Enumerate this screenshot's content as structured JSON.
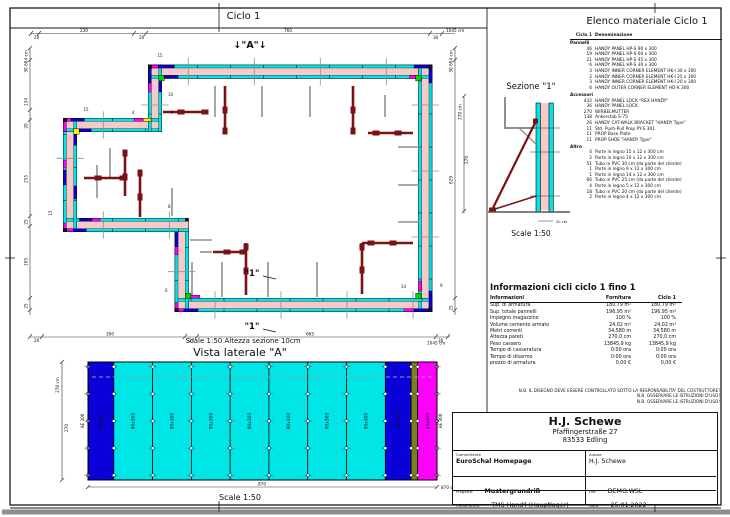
{
  "colors": {
    "panel_cyan": "#00e6e6",
    "concrete_pink": "#f7c9c9",
    "panel_blue": "#0a00d8",
    "panel_magenta": "#ff00ff",
    "panel_green": "#00d400",
    "panel_yellow": "#ffee00",
    "prop_maroon": "#7c1114",
    "wood_olive": "#7e7d1d",
    "gray_line": "#8f8f8f",
    "frame": "#1a1a1a"
  },
  "plan": {
    "title": "Ciclo 1",
    "scale_note": "Scale 1:50   Altezza sezione 10cm",
    "labels": {
      "a_marker": "↓\"A\"↓",
      "one_marker": "\"1\"",
      "small": [
        "15",
        "10",
        "4",
        "4",
        "15",
        "15",
        "8",
        "6",
        "14",
        "9"
      ]
    },
    "dims": {
      "top": [
        "20",
        "230",
        "20",
        "760",
        "30"
      ],
      "top_total": "1045 cm",
      "bottom": [
        "20",
        "300",
        "20",
        "665",
        "30"
      ],
      "bottom_total": "1045 cm",
      "left": [
        "30",
        "134",
        "20",
        "255",
        "25",
        "195",
        "25"
      ],
      "left_total": "664 cm",
      "right": [
        "30",
        "629",
        "25"
      ],
      "right_total": "664 cm",
      "sect_height_label": "270 cm",
      "sect_height_value": "270"
    }
  },
  "sezione": {
    "title": "Sezione \"1\"",
    "scale": "Scale 1:50",
    "dim_small": "20 cm"
  },
  "vista": {
    "title": "Vista laterale \"A\"",
    "scale": "Scale 1:50",
    "dim_left": "270 cm",
    "dim_left_value": "270",
    "dim_bottom_value": "870",
    "dim_bottom_total": "870 cm",
    "edge_left": "AE 300",
    "edge_right": "AE 300",
    "panels": [
      {
        "color": "panel_blue",
        "label": "60x300",
        "cm": 60
      },
      {
        "color": "panel_cyan",
        "label": "90x300",
        "cm": 90
      },
      {
        "color": "panel_cyan",
        "label": "90x300",
        "cm": 90
      },
      {
        "color": "panel_cyan",
        "label": "90x300",
        "cm": 90
      },
      {
        "color": "panel_cyan",
        "label": "90x300",
        "cm": 90
      },
      {
        "color": "panel_cyan",
        "label": "90x300",
        "cm": 90
      },
      {
        "color": "panel_cyan",
        "label": "90x300",
        "cm": 90
      },
      {
        "color": "panel_cyan",
        "label": "90x300",
        "cm": 90
      },
      {
        "color": "panel_blue",
        "label": "60x300",
        "cm": 60
      },
      {
        "color": "wood_olive",
        "label": "",
        "cm": 15
      },
      {
        "color": "panel_magenta",
        "label": "45x300",
        "cm": 45
      }
    ]
  },
  "elenco": {
    "title": "Elenco materiale  Ciclo 1",
    "col_qty": "Ciclo 1",
    "col_name": "Denominazione",
    "sections": [
      {
        "name": "Pannelli",
        "rows": [
          [
            "46",
            "HANDY PANEL HP-S 90 x 300"
          ],
          [
            "19",
            "HANDY PANEL HP-S 60 x 300"
          ],
          [
            "21",
            "HANDY PANEL HP-S 45 x 300"
          ],
          [
            "6",
            "HANDY PANEL HP-S 30 x 300"
          ],
          [
            "3",
            "HANDY INNER CORNER ELEMENT HK-I 30 x 300"
          ],
          [
            "2",
            "HANDY INNER CORNER ELEMENT HK-I 25 x 300"
          ],
          [
            "3",
            "HANDY INNER CORNER ELEMENT HK-I 20 x 300"
          ],
          [
            "6",
            "HANDY OUTER CORNER ELEMENT HD-K 300"
          ]
        ]
      },
      {
        "name": "Accessori",
        "rows": [
          [
            "432",
            "HANDY PANEL LOCK \"REX HANDY\""
          ],
          [
            "36",
            "HANDY PANEL LOCK"
          ],
          [
            "270",
            "WIRBELMUTTER"
          ],
          [
            "138",
            "Ankerstab S-75"
          ],
          [
            "26",
            "HANDY CAT-WALK BRACKET \"HANDY Type\""
          ],
          [
            "11",
            "Std. Push-Pull Prop PY-S 301"
          ],
          [
            "11",
            "PROP Base Plate"
          ],
          [
            "11",
            "PROP SHOE \"HANDY Type\""
          ]
        ]
      },
      {
        "name": "Altro",
        "rows": [
          [
            "4",
            "Parte in legno 15 x 12 x 300 cm"
          ],
          [
            "2",
            "Parte in legno 10 x 12 x 300 cm"
          ],
          [
            "51",
            "Tubo in PVC 30 cm (da parte del cliente)"
          ],
          [
            "1",
            "Parte in legno 9 x 12 x 300 cm"
          ],
          [
            "1",
            "Parte in legno 14 x 12 x 300 cm"
          ],
          [
            "66",
            "Tubo in PVC 25 cm (da parte del cliente)"
          ],
          [
            "4",
            "Parte in legno 5 x 12 x 300 cm"
          ],
          [
            "18",
            "Tubo in PVC 20 cm (da parte del cliente)"
          ],
          [
            "2",
            "Parte in legno 4 x 12 x 300 cm"
          ]
        ]
      }
    ]
  },
  "info": {
    "title": "Informazioni cicli  ciclo 1 fino 1",
    "cols": [
      "Informazioni",
      "Fornitura",
      "Ciclo 1"
    ],
    "rows": [
      [
        "Sup. di armatura",
        "180,79 m²",
        "180,79 m²"
      ],
      [
        "Sup. totale pannelli",
        "196,95 m²",
        "196,95 m²"
      ],
      [
        "Impegno magazzino",
        "100 %",
        "100 %"
      ],
      [
        "Volume cemento armato",
        "24,02 m³",
        "24,02 m³"
      ],
      [
        "Metri correnti",
        "34,580 m",
        "34,580 m"
      ],
      [
        "Altezza pareti",
        "270,0 cm",
        "270,0 cm"
      ],
      [
        "Peso cassero",
        "13845,9 kg",
        "13845,9 kg"
      ],
      [
        "Tempo di casseratura",
        "0:00 ora",
        "0:00 ora"
      ],
      [
        "Tempo di disarmo",
        "0:00 ora",
        "0:00 ora"
      ],
      [
        "prezzo di armatura",
        "0,00 €",
        "0,00 €"
      ]
    ]
  },
  "notes": [
    "N.B. IL DISEGNO DEVE ESSERE CONTROLLATO SOTTO LA RESPONSABILITA' DEL COSTRUTTORE!",
    "N.B. OSSERVARE LE ISTRUZIONI D'USO!",
    "N.B. OSSERVARE LE ISTRUZIONI D'USO!"
  ],
  "titleblock": {
    "company_name": "H.J. Schewe",
    "address1": "Pfaffingerstraße 27",
    "address2": "83533 Edling",
    "labels": {
      "committente": "Committente",
      "autore": "Autore",
      "progetto": "Progetto:",
      "file": "File:",
      "casseratura": "Casseratura:",
      "data": "Data:"
    },
    "values": {
      "committente": "EuroSchal Homepage",
      "autore": "H.J. Schewe",
      "progetto": "Mustergrundriß",
      "file": "DEMO.WSL",
      "casseratura": "TMS Hand'l (Hauptlager)",
      "data": "25.01.2022"
    }
  }
}
